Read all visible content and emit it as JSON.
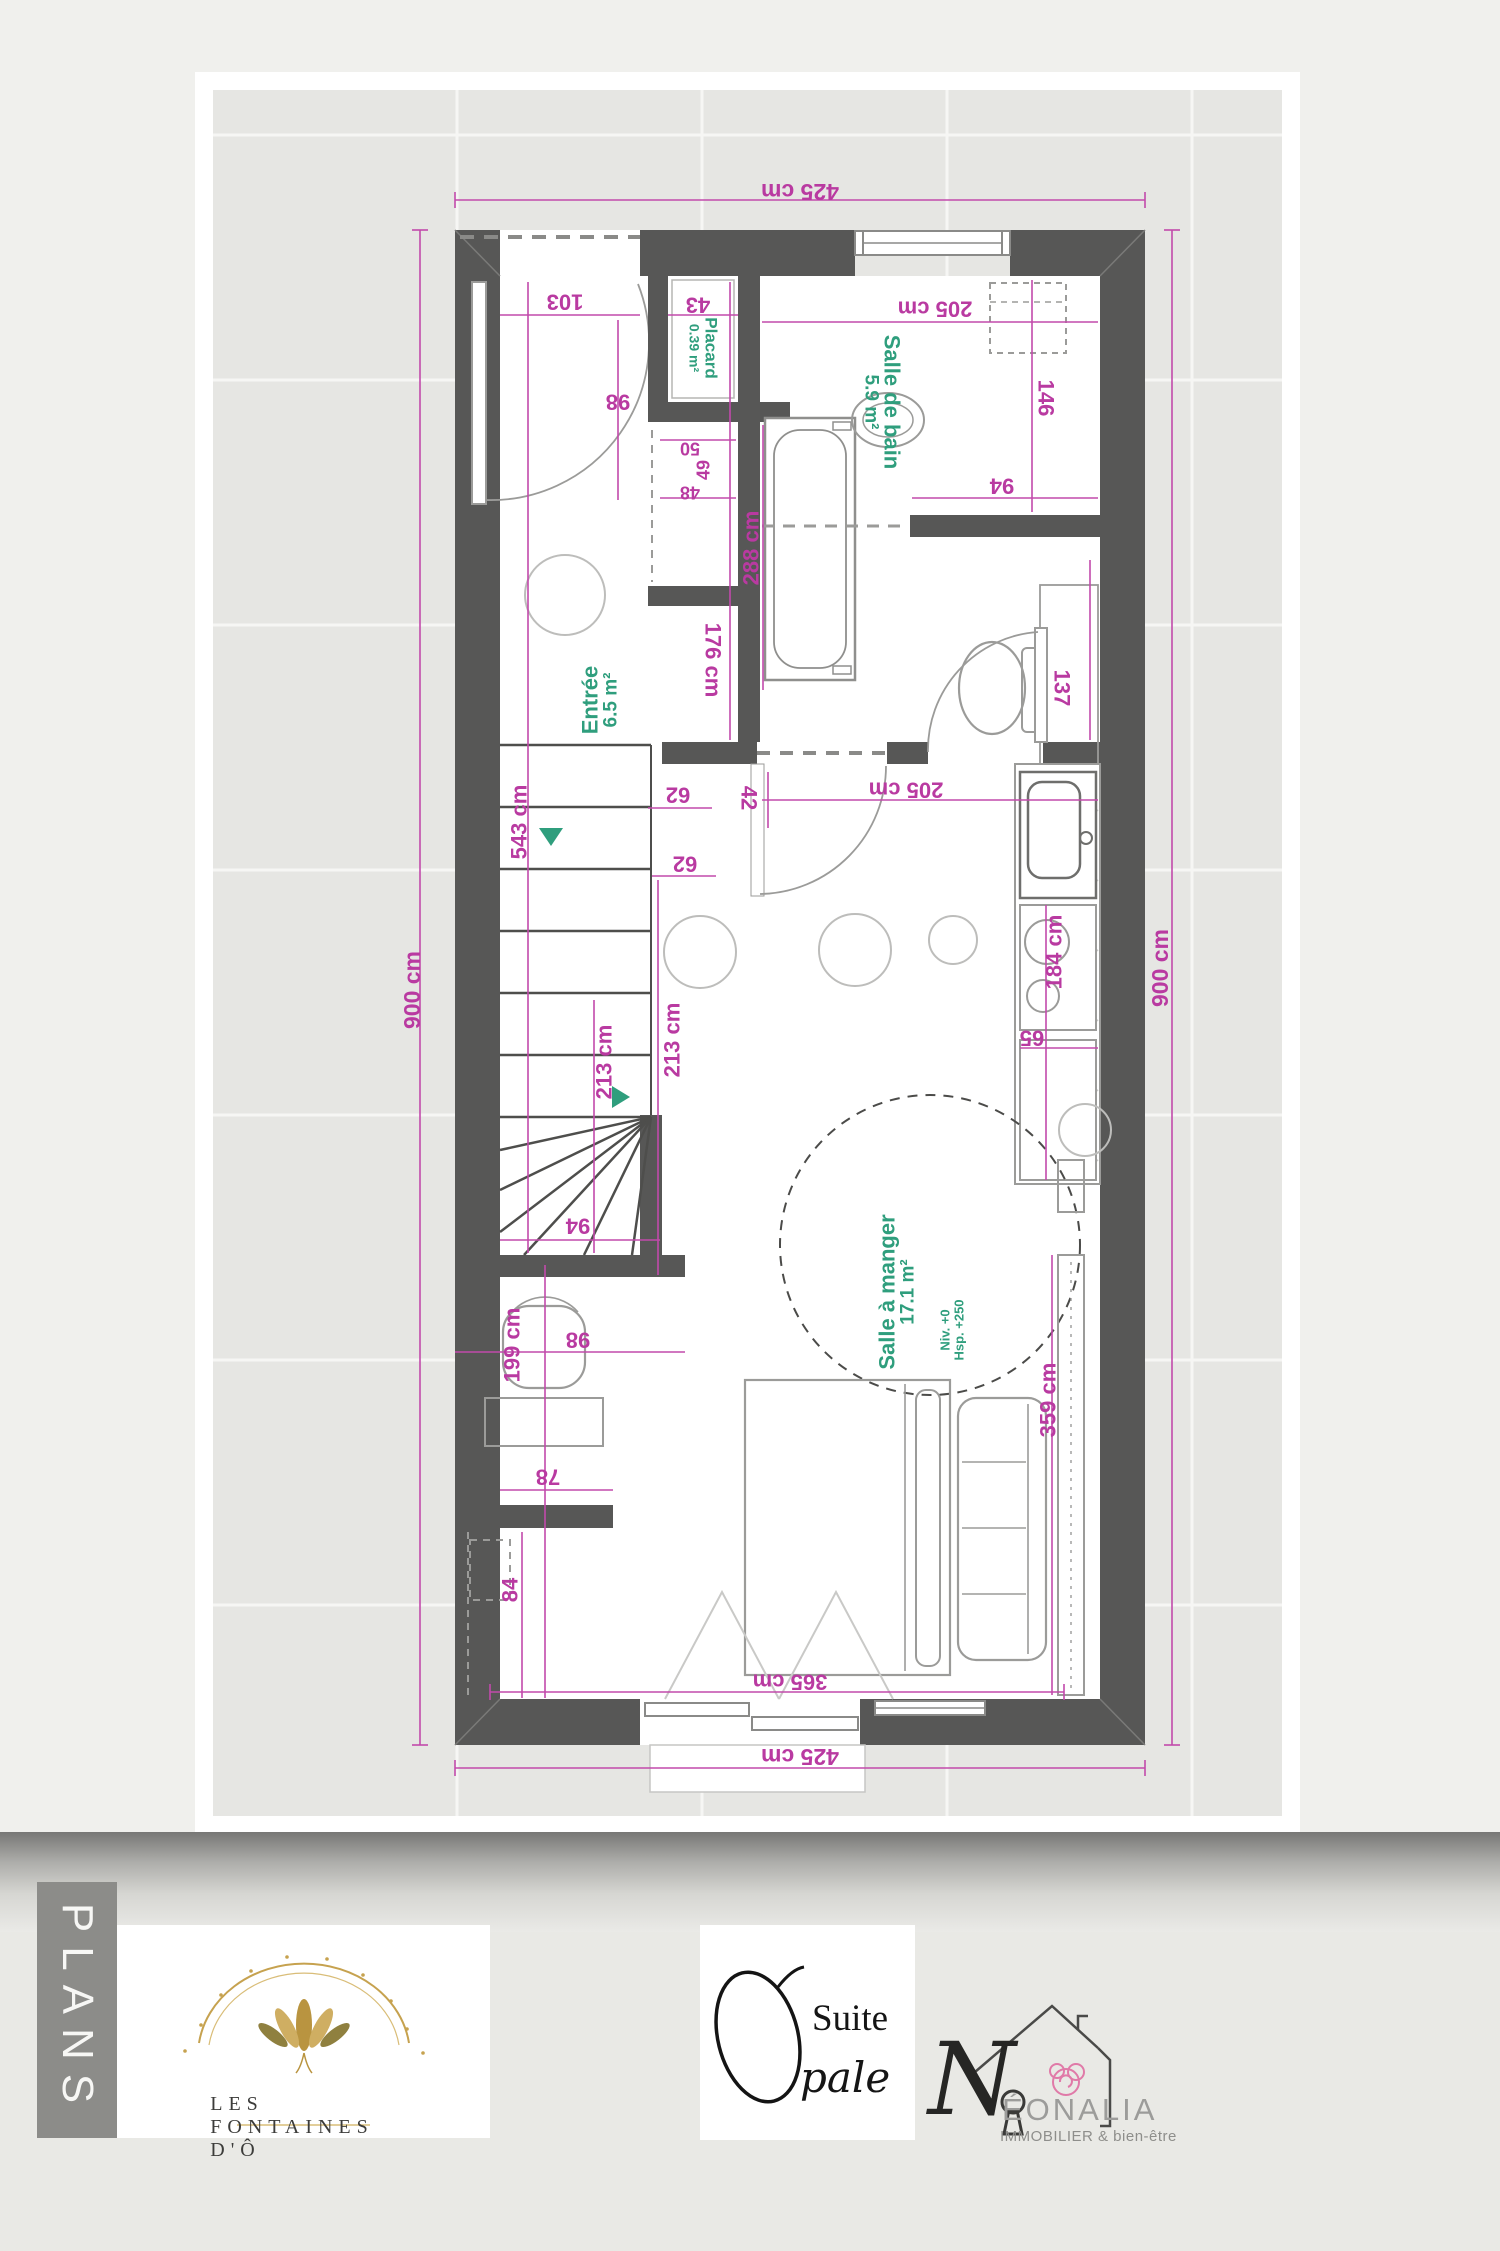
{
  "title": "Plan d'étage - Suite Opale",
  "plan": {
    "rooms": {
      "entree": {
        "name": "Entrée",
        "area": "6.5 m²"
      },
      "placard": {
        "name": "Placard",
        "area": "0.39 m²"
      },
      "bain": {
        "name": "Salle de bain",
        "area": "5.9 m²"
      },
      "manger": {
        "name": "Salle à manger",
        "area": "17.1 m²",
        "note1": "Niv. +0",
        "note2": "Hsp. +250"
      }
    },
    "dims": {
      "top425": "425 cm",
      "bottom425": "425 cm",
      "left900": "900 cm",
      "right900": "900 cm",
      "d103": "103",
      "d98_door": "98",
      "d43": "43",
      "d205_bain": "205 cm",
      "d146": "146",
      "d94_bain": "94",
      "d50": "50",
      "d49": "49",
      "d48": "48",
      "d288": "288 cm",
      "d137": "137",
      "d543": "543 cm",
      "d176": "176 cm",
      "d62_a": "62",
      "d62_b": "62",
      "d42": "42",
      "d205_cuisine": "205 cm",
      "d184": "184 cm",
      "d65": "65",
      "d213_a": "213 cm",
      "d213_b": "213 cm",
      "d94_escalier": "94",
      "d98_escalier": "98",
      "d199": "199 cm",
      "d78": "78",
      "d84": "84",
      "d359": "359 cm",
      "d365": "365 cm"
    },
    "colors": {
      "dimension_text": "#b93aa1",
      "room_text": "#2f9e7d",
      "wall": "#575756",
      "sheet_margin": "#e6e6e3",
      "furniture_line": "#b5b5b3"
    }
  },
  "footer": {
    "sidebar_label": "PLANS",
    "brand": {
      "name": "LES FONTAINES D'Ô",
      "accent_gold": "#c6a24f"
    },
    "suite": {
      "word1": "Suite",
      "word2": "pale",
      "big_letter_o": "O"
    },
    "agency": {
      "initial": "N",
      "name_rest": "ÉONALIA",
      "tagline": "IMMOBILIER & bien-être",
      "flower_pink": "#e07aa8"
    }
  }
}
